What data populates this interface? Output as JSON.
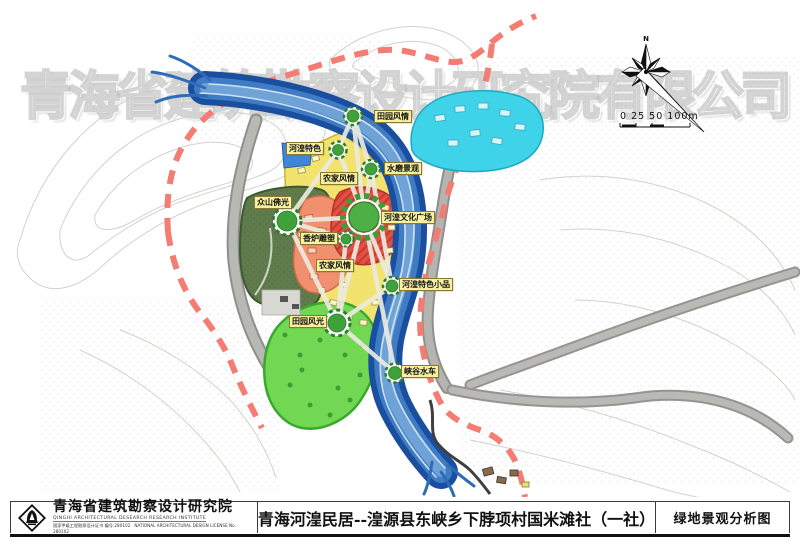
{
  "watermark": "青海省建筑勘察设计研究院有限公司",
  "compass": {
    "north_label": "N"
  },
  "scale_bar": {
    "label": "0 25 50 100m"
  },
  "map": {
    "labels": [
      {
        "text": "田园风情"
      },
      {
        "text": "河湟特色"
      },
      {
        "text": "水磨景观"
      },
      {
        "text": "农家风情"
      },
      {
        "text": "众山佛光"
      },
      {
        "text": "河湟文化广场"
      },
      {
        "text": "香炉雕塑"
      },
      {
        "text": "农家风情"
      },
      {
        "text": "河湟特色小品"
      },
      {
        "text": "田园风光"
      },
      {
        "text": "峡谷水车"
      }
    ],
    "zone_colors": {
      "farmhouse_yellow": "#f2e36e",
      "plaza_red": "#e34f42",
      "sculpture_salmon": "#f0906e",
      "mountain_darkgreen": "#617c4c",
      "pastoral_green": "#72d854",
      "water_cyan": "#3ed3e8",
      "river_blue": "#1d57ab",
      "boundary_dash_red": "#f47c72"
    }
  },
  "title_block": {
    "institute_cn": "青海省建筑勘察设计研究院",
    "institute_en": "QINGHI ARCHITECTURAL DESEARCH RESEARCH INSTITUTE",
    "license_cn": "国家甲级工程勘察设计证书 编号:280102",
    "license_en": "NATIONAL ARCHITECTURAL DESIGN LICENSE No. 280102",
    "project_title": "青海河湟民居--湟源县东峡乡下脖项村国米滩社（一社）",
    "drawing_title": "绿地景观分析图"
  }
}
